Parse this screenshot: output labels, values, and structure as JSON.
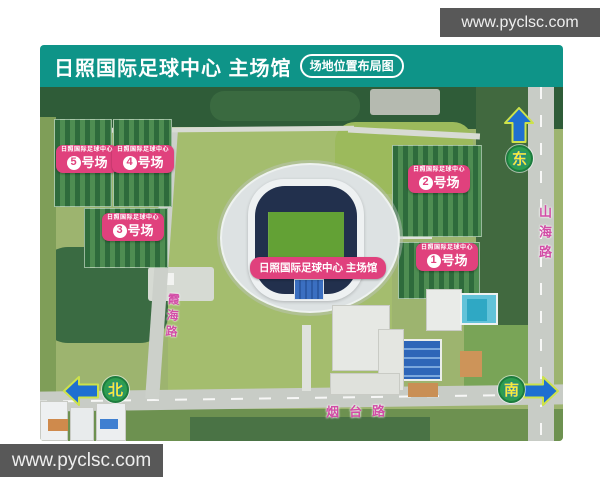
{
  "site": {
    "watermark": "www.pyclsc.com"
  },
  "header": {
    "title": "日照国际足球中心 主场馆",
    "tag": "场地位置布局图"
  },
  "stadium": {
    "label": "日照国际足球中心 主场馆"
  },
  "fields": [
    {
      "org": "日照国际足球中心",
      "num": "5",
      "unit": "号场"
    },
    {
      "org": "日照国际足球中心",
      "num": "4",
      "unit": "号场"
    },
    {
      "org": "日照国际足球中心",
      "num": "3",
      "unit": "号场"
    },
    {
      "org": "日照国际足球中心",
      "num": "2",
      "unit": "号场"
    },
    {
      "org": "日照国际足球中心",
      "num": "1",
      "unit": "号场"
    }
  ],
  "roads": {
    "xiahai": "霞海路",
    "yantai": "烟台路",
    "shanhai": "山海路"
  },
  "compass": {
    "east": "东",
    "north": "北",
    "south": "南"
  },
  "colors": {
    "header_teal": "#0E9488",
    "badge_pink": "#E0417D",
    "road_label_pink": "#D24DA6",
    "compass_green": "#2E9E4F",
    "compass_yellow": "#F7EC3A",
    "arrow_blue": "#1F6FD0",
    "banner_gray": "#585858"
  }
}
